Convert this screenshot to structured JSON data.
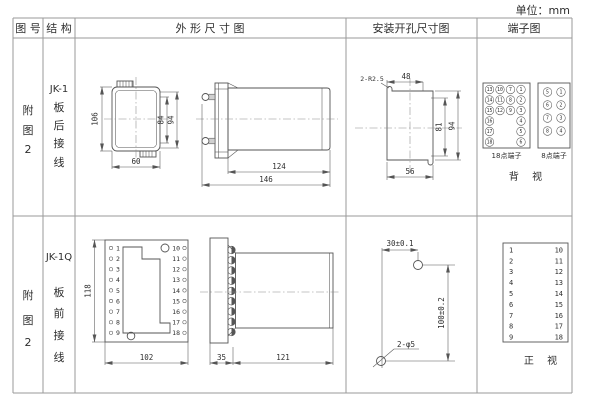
{
  "page": {
    "unit": "单位：mm"
  },
  "headers": {
    "fig": "图 号",
    "structure": "结 构",
    "outline": "外 形 尺 寸 图",
    "mounting": "安装开孔尺寸图",
    "terminal": "端子图"
  },
  "row1": {
    "fig": [
      "附",
      "图",
      "2"
    ],
    "model": "JK-1",
    "wiring": [
      "板",
      "后",
      "接",
      "线"
    ],
    "dims": {
      "h106": "106",
      "h84": "84",
      "h94": "94",
      "w60": "60",
      "l124": "124",
      "l146": "146"
    },
    "mount": {
      "radius": "2-R2.5",
      "w48": "48",
      "h81": "81",
      "h94": "94",
      "w56": "56"
    },
    "term": {
      "label18": "18点端子",
      "label8": "8点端子",
      "view": "背 视",
      "t18c1": [
        13,
        14,
        15,
        16,
        17,
        18
      ],
      "t18c2": [
        10,
        11,
        12
      ],
      "t18c3": [
        7,
        8,
        9
      ],
      "t18c4": [
        1,
        2,
        3,
        4,
        5,
        6
      ],
      "t8c1": [
        5,
        6,
        7,
        8
      ],
      "t8c2": [
        1,
        2,
        3,
        4
      ]
    }
  },
  "row2": {
    "fig": [
      "附",
      "图",
      "2"
    ],
    "model": "JK-1Q",
    "wiring": [
      "板",
      "前",
      "接",
      "线"
    ],
    "dims": {
      "h118": "118",
      "w102": "102",
      "d35": "35",
      "d121": "121"
    },
    "panel_left": [
      "1",
      "2",
      "3",
      "4",
      "5",
      "6",
      "7",
      "8",
      "9"
    ],
    "panel_right": [
      "10",
      "11",
      "12",
      "13",
      "14",
      "15",
      "16",
      "17",
      "18"
    ],
    "mount": {
      "dx": "30±0.1",
      "dy": "100±0.2",
      "holes": "2-φ5"
    },
    "term": {
      "left": [
        "1",
        "2",
        "3",
        "4",
        "5",
        "6",
        "7",
        "8",
        "9"
      ],
      "right": [
        "10",
        "11",
        "12",
        "13",
        "14",
        "15",
        "16",
        "17",
        "18"
      ],
      "view": "正 视"
    }
  }
}
